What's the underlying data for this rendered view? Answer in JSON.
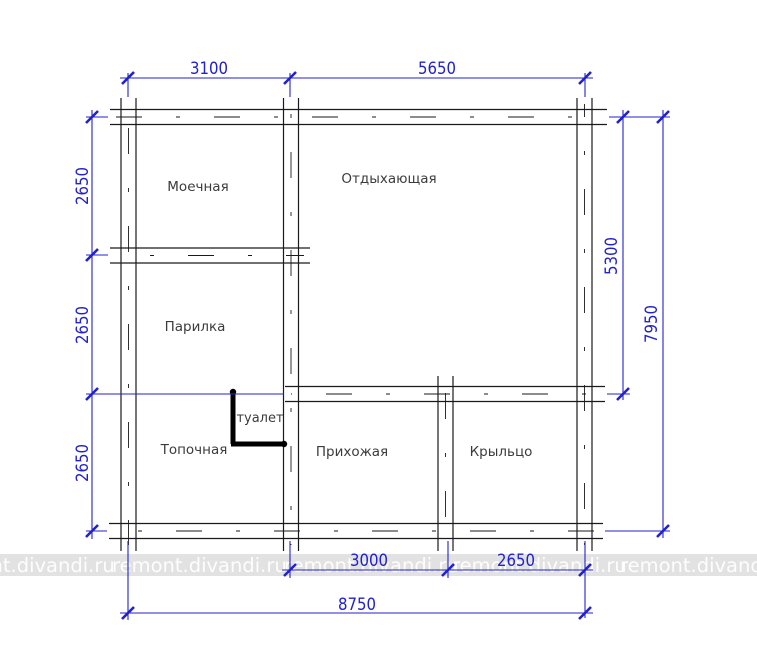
{
  "canvas": {
    "width": 757,
    "height": 672,
    "background": "#ffffff"
  },
  "colors": {
    "wall": "#1a1a1a",
    "dimension_blue": "#2222cc",
    "room_label": "#3c3c3c",
    "toilet_partition": "#000000",
    "watermark_band": "#bfbfbf",
    "watermark_text": "#ffffff"
  },
  "rooms": [
    {
      "name": "room-label-washroom",
      "label": "Моечная",
      "x": 198,
      "y": 191,
      "size": 13.5
    },
    {
      "name": "room-label-lounge",
      "label": "Отдыхающая",
      "x": 389,
      "y": 183,
      "size": 13.5
    },
    {
      "name": "room-label-steamroom",
      "label": "Парилка",
      "x": 195,
      "y": 331,
      "size": 13.5
    },
    {
      "name": "room-label-furnace",
      "label": "Топочная",
      "x": 194,
      "y": 454,
      "size": 13.5
    },
    {
      "name": "room-label-toilet",
      "label": "туалет",
      "x": 260,
      "y": 422,
      "size": 13
    },
    {
      "name": "room-label-hallway",
      "label": "Прихожая",
      "x": 352,
      "y": 456,
      "size": 13.5
    },
    {
      "name": "room-label-porch",
      "label": "Крыльцо",
      "x": 501,
      "y": 456,
      "size": 13.5
    }
  ],
  "dimension_labels": [
    {
      "name": "dim-label-3100",
      "text": "3100",
      "x": 209,
      "y": 74,
      "rot": 0
    },
    {
      "name": "dim-label-5650",
      "text": "5650",
      "x": 437,
      "y": 74,
      "rot": 0
    },
    {
      "name": "dim-label-2650-top",
      "text": "2650",
      "x": 88,
      "y": 186,
      "rot": -90
    },
    {
      "name": "dim-label-2650-middle",
      "text": "2650",
      "x": 88,
      "y": 325,
      "rot": -90
    },
    {
      "name": "dim-label-2650-bottom",
      "text": "2650",
      "x": 88,
      "y": 463,
      "rot": -90
    },
    {
      "name": "dim-label-5300",
      "text": "5300",
      "x": 617,
      "y": 256,
      "rot": -90
    },
    {
      "name": "dim-label-7950",
      "text": "7950",
      "x": 657,
      "y": 324,
      "rot": -90
    },
    {
      "name": "dim-label-3000",
      "text": "3000",
      "x": 369,
      "y": 566,
      "rot": 0
    },
    {
      "name": "dim-label-2650-porch",
      "text": "2650",
      "x": 516,
      "y": 566,
      "rot": 0
    },
    {
      "name": "dim-label-8750",
      "text": "8750",
      "x": 357,
      "y": 610,
      "rot": 0
    }
  ],
  "watermark": {
    "text": "remont.divandi.ru",
    "band_y": 554,
    "band_h": 22,
    "baseline": 572,
    "starts": [
      -60,
      112,
      284,
      452,
      620
    ]
  },
  "floorplan": {
    "walls": [
      {
        "name": "top-exterior-wall",
        "o": "h",
        "c": 117,
        "t": 15,
        "a": 110,
        "b": 607
      },
      {
        "name": "bottom-exterior-wall",
        "o": "h",
        "c": 531,
        "t": 15,
        "a": 109,
        "b": 603
      },
      {
        "name": "left-exterior-wall",
        "o": "v",
        "c": 128.5,
        "t": 15,
        "a": 98,
        "b": 551
      },
      {
        "name": "right-exterior-wall",
        "o": "v",
        "c": 584.5,
        "t": 15,
        "a": 98,
        "b": 551
      },
      {
        "name": "central-wall",
        "o": "v",
        "c": 291,
        "t": 15,
        "a": 98,
        "b": 551
      },
      {
        "name": "porch-divider-wall",
        "o": "v",
        "c": 445.5,
        "t": 15,
        "a": 376,
        "b": 551
      },
      {
        "name": "washroom-steamroom-wall",
        "o": "h",
        "c": 255.5,
        "t": 15,
        "a": 110,
        "b": 310
      },
      {
        "name": "hallway-top-wall",
        "o": "h",
        "c": 394,
        "t": 15,
        "a": 285,
        "b": 605
      }
    ],
    "dim_lines": [
      {
        "name": "dim-line-top",
        "o": "h",
        "c": 78,
        "a": 120,
        "b": 593
      },
      {
        "name": "dim-line-left",
        "o": "v",
        "c": 92,
        "a": 110,
        "b": 539
      },
      {
        "name": "dim-line-5300",
        "o": "v",
        "c": 623,
        "a": 110,
        "b": 400
      },
      {
        "name": "dim-line-7950",
        "o": "v",
        "c": 663,
        "a": 110,
        "b": 538
      },
      {
        "name": "dim-line-bottom-inner",
        "o": "h",
        "c": 570,
        "a": 282,
        "b": 593
      },
      {
        "name": "dim-line-bottom-outer",
        "o": "h",
        "c": 613,
        "a": 120,
        "b": 593
      }
    ],
    "ext_lines": [
      {
        "o": "v",
        "c": 128,
        "a": 73,
        "b": 97
      },
      {
        "o": "v",
        "c": 290,
        "a": 73,
        "b": 97
      },
      {
        "o": "v",
        "c": 585,
        "a": 73,
        "b": 97
      },
      {
        "o": "h",
        "c": 117,
        "a": 86,
        "b": 108
      },
      {
        "o": "h",
        "c": 255,
        "a": 86,
        "b": 108
      },
      {
        "o": "h",
        "c": 394,
        "a": 86,
        "b": 284
      },
      {
        "o": "h",
        "c": 531,
        "a": 86,
        "b": 107
      },
      {
        "o": "h",
        "c": 117,
        "a": 609,
        "b": 670
      },
      {
        "o": "h",
        "c": 394,
        "a": 607,
        "b": 630
      },
      {
        "o": "h",
        "c": 531,
        "a": 605,
        "b": 670
      },
      {
        "o": "v",
        "c": 290,
        "a": 541,
        "b": 578
      },
      {
        "o": "v",
        "c": 448,
        "a": 541,
        "b": 578
      },
      {
        "o": "v",
        "c": 585,
        "a": 541,
        "b": 618
      },
      {
        "o": "v",
        "c": 128,
        "a": 541,
        "b": 620
      }
    ],
    "ticks": [
      [
        128,
        78
      ],
      [
        290,
        78
      ],
      [
        585,
        78
      ],
      [
        92,
        117
      ],
      [
        92,
        255
      ],
      [
        92,
        394
      ],
      [
        92,
        531
      ],
      [
        623,
        117
      ],
      [
        623,
        394
      ],
      [
        663,
        117
      ],
      [
        663,
        531
      ],
      [
        290,
        570
      ],
      [
        448,
        570
      ],
      [
        585,
        570
      ],
      [
        128,
        613
      ],
      [
        585,
        613
      ]
    ],
    "toilet": {
      "v": {
        "x": 233,
        "y1": 391,
        "y2": 444
      },
      "h": {
        "y": 444,
        "x1": 231,
        "x2": 285
      },
      "dots": [
        [
          233,
          392
        ],
        [
          284,
          444
        ]
      ],
      "width": 5
    }
  }
}
